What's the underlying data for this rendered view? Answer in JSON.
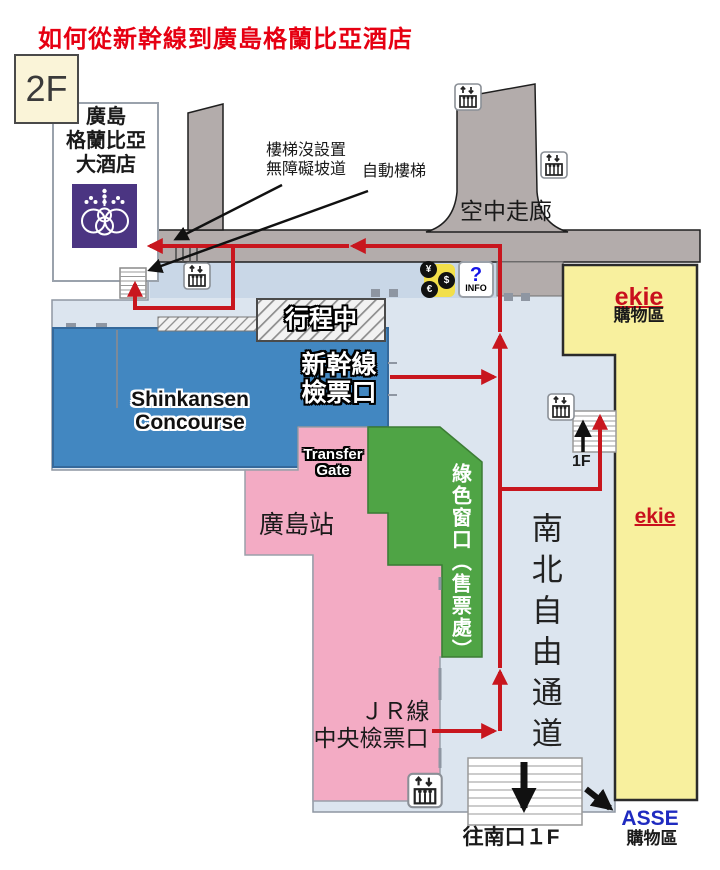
{
  "title": "如何從新幹線到廣島格蘭比亞酒店",
  "floor_badge": "2F",
  "hotel": {
    "line1": "廣島",
    "line2": "格蘭比亞",
    "line3": "大酒店"
  },
  "annotations": {
    "no_ramp_line1": "樓梯沒設置",
    "no_ramp_line2": "無障礙坡道",
    "escalator": "自動樓梯"
  },
  "areas": {
    "sky_corridor": "空中走廊",
    "under_way": "行程中",
    "concourse_line1": "Shinkansen",
    "concourse_line2": "Concourse",
    "shinkansen_gate_line1": "新幹線",
    "shinkansen_gate_line2": "檢票口",
    "transfer_line1": "Transfer",
    "transfer_line2": "Gate",
    "station": "廣島站",
    "green_window": "綠色窗口（售票處）",
    "passage": "南北自由通道",
    "jr_line1": "ＪＲ線",
    "jr_line2": "中央檢票口"
  },
  "labels": {
    "floor_1f": "1F",
    "to_south_exit": "往南口１F"
  },
  "shops": {
    "ekie_top": "ekie",
    "ekie_top_type": "購物區",
    "ekie_mid": "ekie",
    "asse": "ASSE",
    "asse_type": "購物區"
  },
  "money_icon": {
    "yen": "¥",
    "dollar": "$",
    "euro": "€"
  },
  "info_icon": {
    "mark": "?",
    "label": "INFO"
  },
  "colors": {
    "title_red": "#e60012",
    "route_red": "#c8161e",
    "concourse_blue": "#4287c1",
    "station_pink": "#f3abc4",
    "ticket_green": "#4fa445",
    "ekie_yellow": "#f8f09e",
    "walkway_gray": "#b3acab",
    "floor_blue": "#dce5ef",
    "floor_strip_blue": "#c9d7e7",
    "hotel_purple": "#4b3582",
    "badge_cream": "#faf4d8",
    "asse_blue": "#1f2bc0",
    "ekie_red": "#c9101d"
  }
}
